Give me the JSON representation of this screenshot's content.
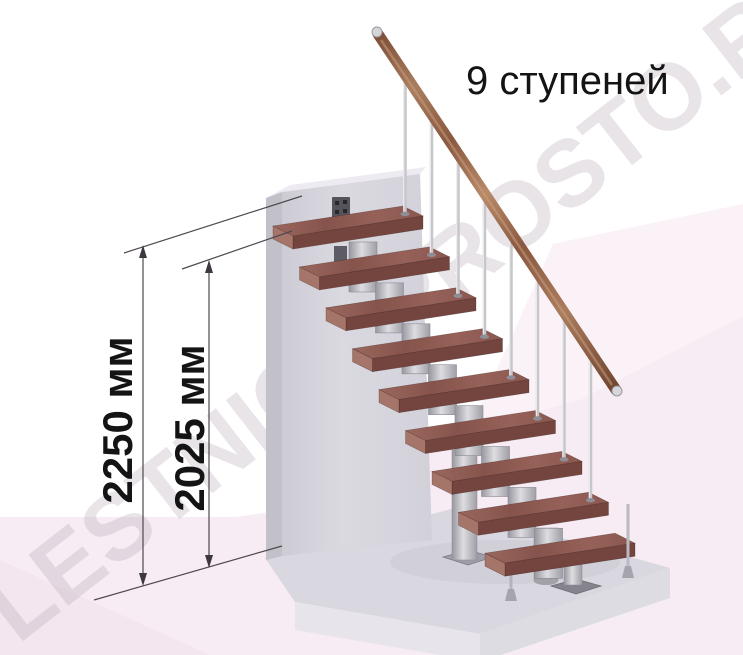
{
  "illustration": {
    "step_count_label": "9 ступеней",
    "watermark": "LESTNICY-PROSTO.RU",
    "steps": {
      "count": 9
    },
    "dimensions": [
      {
        "label": "2250 мм"
      },
      {
        "label": "2025 мм"
      }
    ],
    "colors": {
      "tread_wood": "#8d5b52",
      "handrail_wood": "#9a6b4e",
      "metal": "#c2c1c7",
      "wall_gray": "#d7d5dd",
      "platform_gray": "#d9d7df",
      "floor_pink": "#f7ecf4",
      "dimension_line": "#4e4850",
      "label_text": "#141414",
      "watermark_gray": "#b9aeb9"
    }
  }
}
